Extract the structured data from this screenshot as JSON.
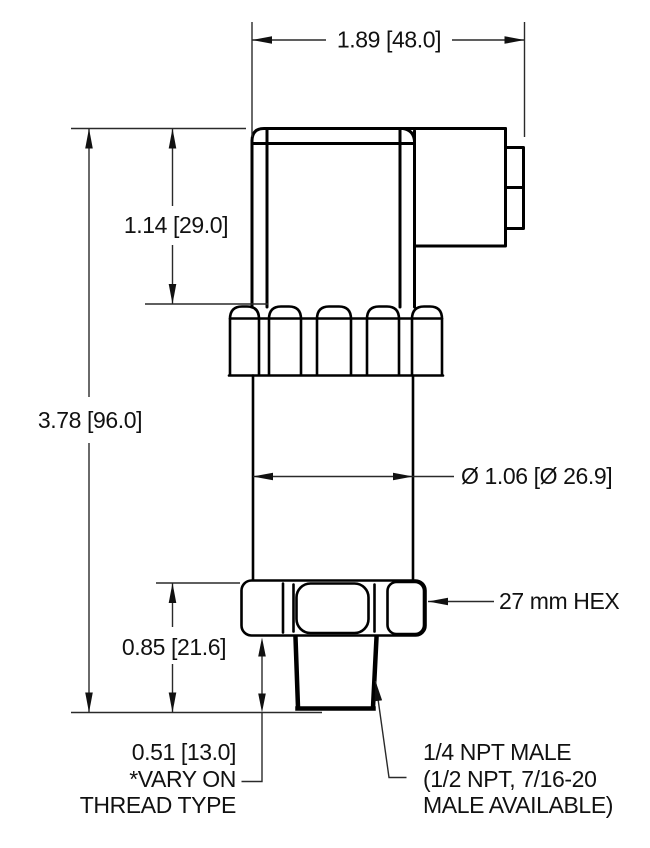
{
  "drawing": {
    "type": "technical-dimension-drawing",
    "subject": "pressure-transducer-side-view",
    "background_color": "#ffffff",
    "line_color": "#000000",
    "dimension_line_color": "#2a2a2a",
    "labels": {
      "top_width": "1.89 [48.0]",
      "upper_body_height": "1.14 [29.0]",
      "overall_height": "3.78 [96.0]",
      "body_diameter": "Ø 1.06 [Ø 26.9]",
      "hex_size": "27 mm HEX",
      "lower_section_height": "0.85 [21.6]",
      "thread_length": "0.51 [13.0]",
      "thread_note_line1": "*VARY ON",
      "thread_note_line2": "THREAD TYPE",
      "port_line1": "1/4 NPT MALE",
      "port_line2": "(1/2 NPT, 7/16-20",
      "port_line3": "MALE AVAILABLE)"
    }
  }
}
